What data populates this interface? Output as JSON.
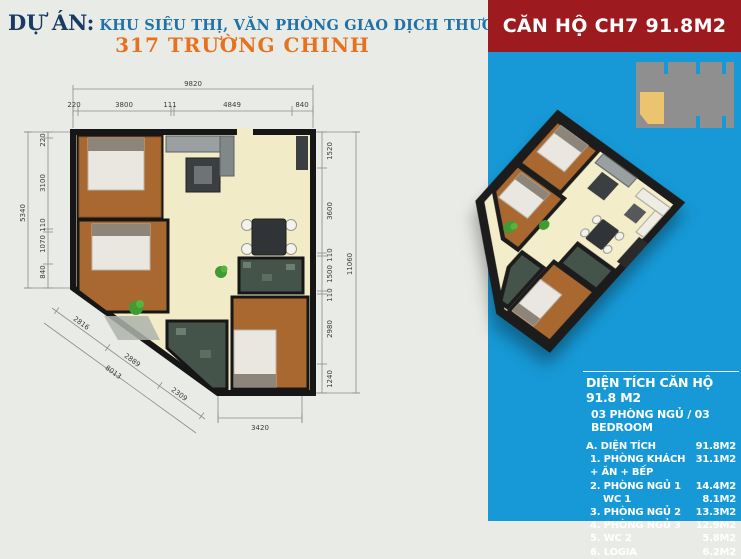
{
  "header": {
    "project_label": "DỰ ÁN:",
    "project_name": "KHU SIÊU THỊ, VĂN PHÒNG GIAO DỊCH THƯƠNG MẠI VÀ NHÀ Ở",
    "project_address": "317 TRƯỜNG CHINH"
  },
  "unit_banner": {
    "title": "CĂN HỘ CH7 91.8M2"
  },
  "colors": {
    "panel_blue": "#1699d6",
    "banner_red": "#9d1b1f",
    "address_orange": "#e7711f",
    "header_navy": "#1a3a66",
    "header_blue": "#2172a8",
    "wood_floor": "#a8682f",
    "living_cream": "#f1ebc8",
    "wc_tile": "#45544a",
    "wall_black": "#161616",
    "keyplan_gray": "#8f8f8f",
    "keyplan_unit_yellow": "#ecc46f"
  },
  "floor_plan": {
    "dims_top": {
      "overall": "9820",
      "segments": [
        "220",
        "3800",
        "111",
        "4849",
        "840"
      ]
    },
    "dims_left": {
      "overall": "5340",
      "segments": [
        "220",
        "3100",
        "110",
        "1070",
        "840"
      ]
    },
    "dims_right": {
      "overall": "11060",
      "segments": [
        "1520",
        "3600",
        "110",
        "1500",
        "110",
        "2980",
        "1240"
      ]
    },
    "dims_diag": {
      "overall": "8013",
      "segments": [
        "2816",
        "2889",
        "2309"
      ]
    },
    "dims_bottom": {
      "segments": [
        "3420"
      ]
    }
  },
  "area_table": {
    "title": "DIỆN TÍCH CĂN HỘ 91.8 M2",
    "subtitle": "03 PHÒNG NGỦ / 03 BEDROOM",
    "rows": [
      {
        "label": "A. DIỆN TÍCH",
        "value": "91.8M2"
      },
      {
        "label": "1. PHÒNG KHÁCH + ĂN + BẾP",
        "value": "31.1M2"
      },
      {
        "label": "2. PHÒNG NGỦ 1",
        "value": "14.4M2"
      },
      {
        "label": "WC 1",
        "value": "8.1M2"
      },
      {
        "label": "3. PHÒNG NGỦ 2",
        "value": "13.3M2"
      },
      {
        "label": "4. PHÒNG NGỦ 3",
        "value": "12.9M2"
      },
      {
        "label": "5. WC 2",
        "value": "5.8M2"
      },
      {
        "label": "6. LOGIA",
        "value": "6.2M2"
      }
    ]
  }
}
